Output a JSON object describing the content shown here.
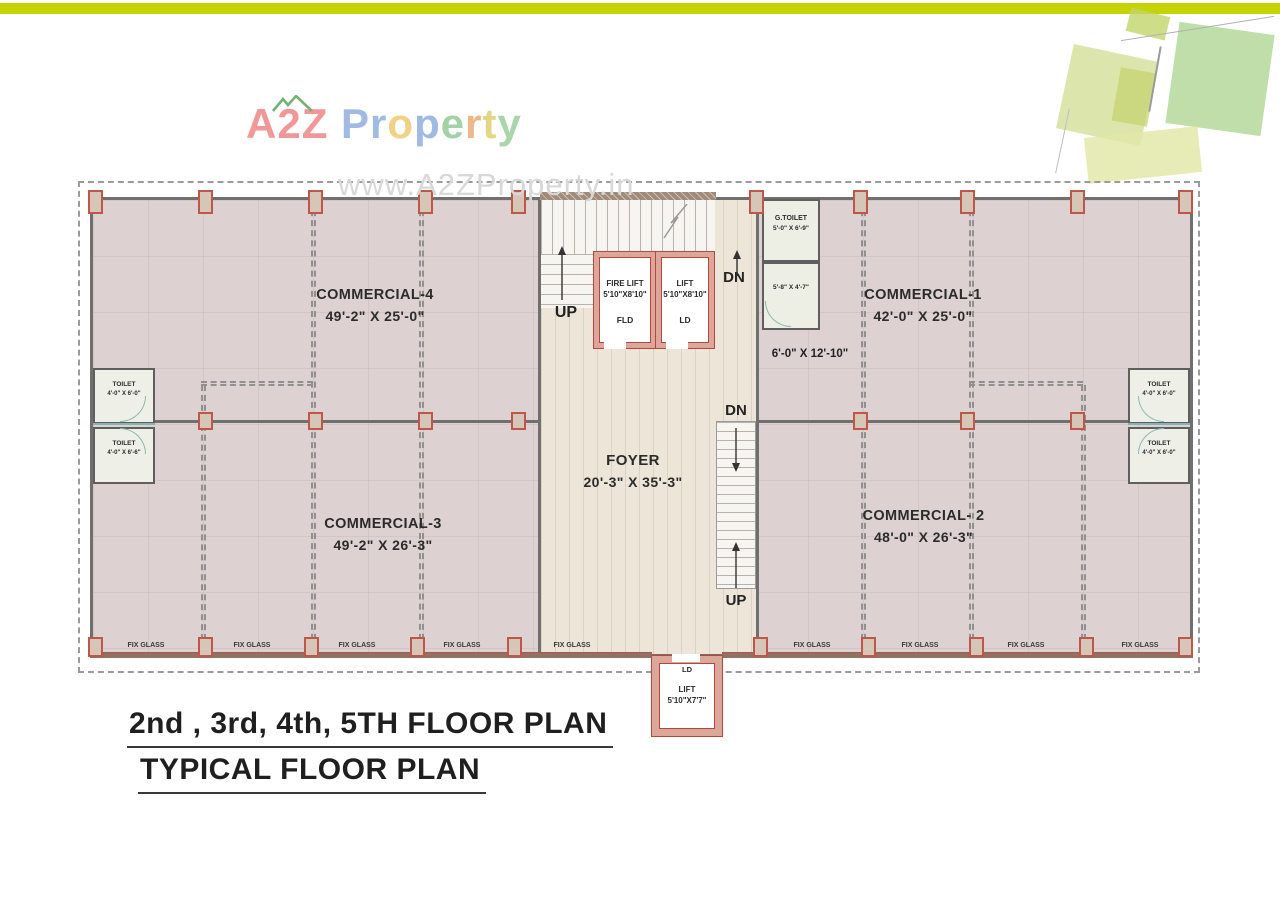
{
  "brand": {
    "logo_a2z": "A2Z",
    "logo_property_letters": [
      "P",
      "r",
      "o",
      "p",
      "e",
      "r",
      "t",
      "y"
    ],
    "watermark": "www.A2ZProperty.in",
    "colors": {
      "top_bar": "#c6d202",
      "logo_red": "#ee8181",
      "logo_blue": "#8cabdf",
      "logo_yellow": "#eec768",
      "logo_green": "#92c992",
      "logo_orange": "#eea76c",
      "deco_green_dark": "#a9d38c",
      "deco_green_light": "#d3df96",
      "wall_gray": "#6f6f6f",
      "wall_brown": "#8e7263",
      "column_red": "#bf564a",
      "room_fill": "#ddd1d1",
      "foyer_fill": "#ece5d8"
    }
  },
  "titles": {
    "line1": "2nd , 3rd, 4th, 5TH FLOOR PLAN",
    "line2": "TYPICAL FLOOR PLAN"
  },
  "plan": {
    "stair_labels": {
      "up": "UP",
      "dn": "DN"
    },
    "fix_glass": "FIX GLASS",
    "rooms": {
      "commercial4": {
        "name": "COMMERCIAL-4",
        "size": "49'-2\" X 25'-0\""
      },
      "commercial1": {
        "name": "COMMERCIAL-1",
        "size": "42'-0\" X 25'-0\""
      },
      "commercial3": {
        "name": "COMMERCIAL-3",
        "size": "49'-2\" X 26'-3\""
      },
      "commercial2": {
        "name": "COMMERCIAL- 2",
        "size": "48'-0\" X 26'-3\""
      },
      "foyer": {
        "name": "FOYER",
        "size": "20'-3\" X 35'-3\""
      },
      "fire_lift": {
        "name": "FIRE LIFT",
        "size": "5'10\"X8'10\"",
        "door_label": "FLD"
      },
      "lift_top": {
        "name": "LIFT",
        "size": "5'10\"X8'10\"",
        "door_label": "LD"
      },
      "lift_bottom": {
        "name": "LIFT",
        "size": "5'10\"X7'7\"",
        "door_label": "LD"
      },
      "g_toilet": {
        "name": "G.TOILET",
        "size": "5'-0\" X 6'-9\""
      },
      "wash_area": {
        "size": "5'-8\" X 4'-7\""
      },
      "passage": {
        "size": "6'-0\" X 12'-10\""
      },
      "toilet_left_top": {
        "name": "TOILET",
        "size": "4'-0\" X 6'-0\""
      },
      "toilet_left_bottom": {
        "name": "TOILET",
        "size": "4'-0\" X 6'-6\""
      },
      "toilet_right_top": {
        "name": "TOILET",
        "size": "4'-0\" X 6'-0\""
      },
      "toilet_right_bottom": {
        "name": "TOILET",
        "size": "4'-0\" X 6'-0\""
      }
    }
  }
}
